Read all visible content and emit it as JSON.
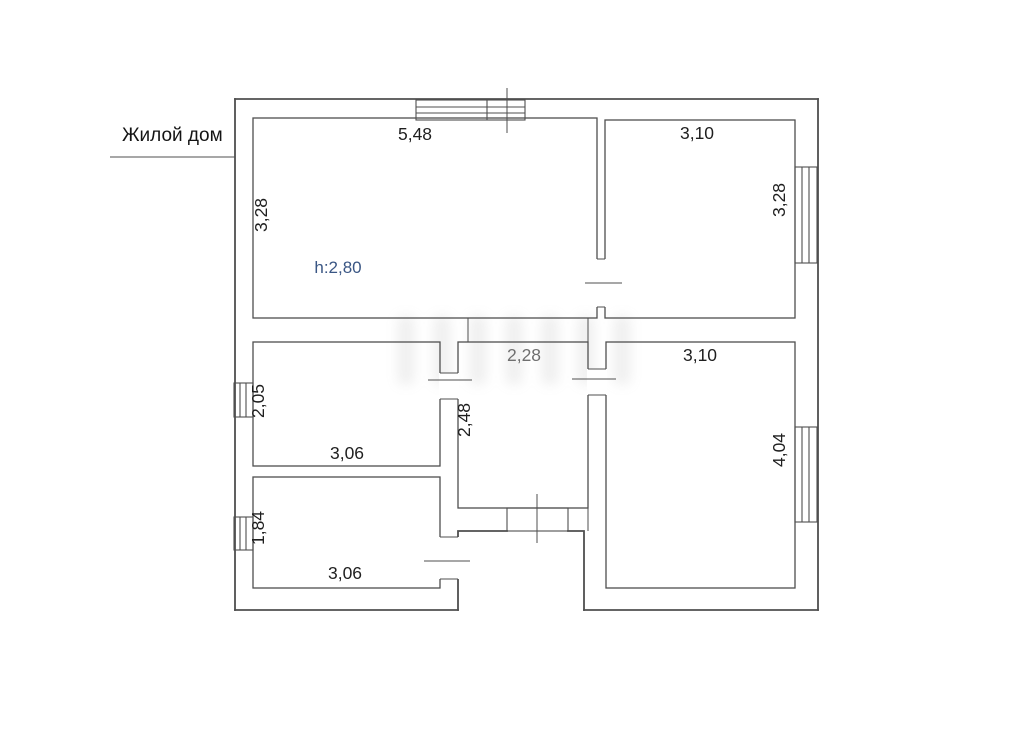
{
  "page": {
    "title": "Жилой дом"
  },
  "plan": {
    "rooms": [
      {
        "name": "room-top-left",
        "width": "5,48",
        "height": "3,28",
        "ceiling": "h:2,80"
      },
      {
        "name": "room-top-right",
        "width": "3,10",
        "height": "3,28"
      },
      {
        "name": "room-middle-left",
        "width": "3,06",
        "height": "2,05"
      },
      {
        "name": "room-bottom-left",
        "width": "3,06",
        "height": "1,84"
      },
      {
        "name": "hallway",
        "width": "2,28",
        "depth": "2,48"
      },
      {
        "name": "room-right",
        "width": "3,10",
        "height": "4,04"
      }
    ],
    "colors": {
      "wall_line": "#4f4f4f",
      "dimension_text": "#1f1f1f",
      "ceiling_text": "#3a5684",
      "hall_dim_text": "#6f6f6f"
    }
  }
}
